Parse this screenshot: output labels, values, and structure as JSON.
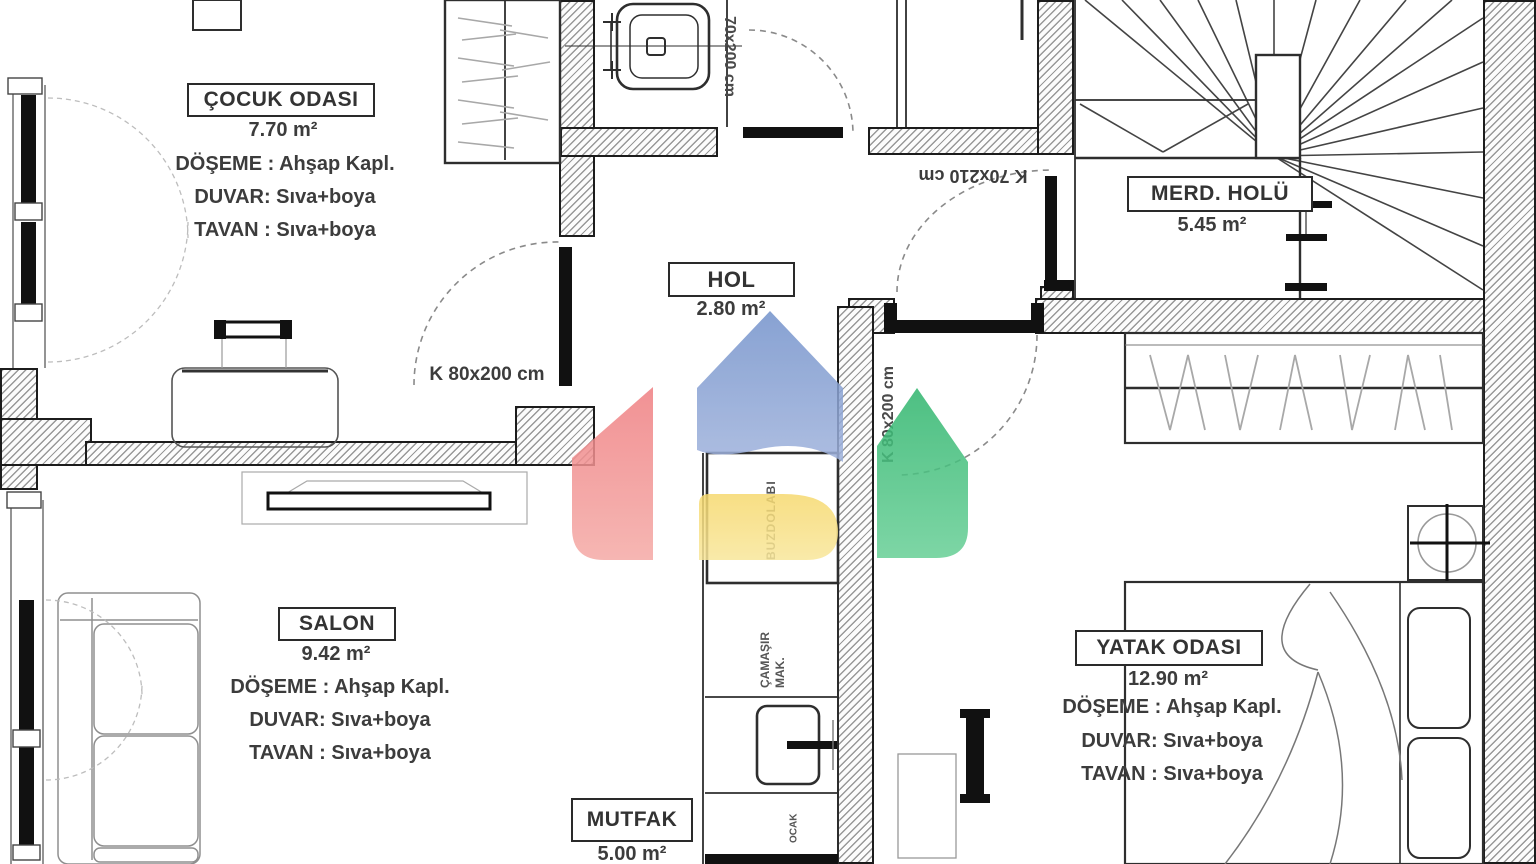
{
  "rooms": {
    "cocuk_odasi": {
      "name": "ÇOCUK ODASI",
      "area": "7.70 m²",
      "floor": "DÖŞEME : Ahşap Kapl.",
      "wall": "DUVAR: Sıva+boya",
      "ceiling": "TAVAN : Sıva+boya"
    },
    "hol": {
      "name": "HOL",
      "area": "2.80 m²"
    },
    "merd_holu": {
      "name": "MERD. HOLÜ",
      "area": "5.45 m²"
    },
    "salon": {
      "name": "SALON",
      "area": "9.42 m²",
      "floor": "DÖŞEME : Ahşap Kapl.",
      "wall": "DUVAR: Sıva+boya",
      "ceiling": "TAVAN : Sıva+boya"
    },
    "mutfak": {
      "name": "MUTFAK",
      "area": "5.00 m²"
    },
    "yatak_odasi": {
      "name": "YATAK ODASI",
      "area": "12.90 m²",
      "floor": "DÖŞEME : Ahşap Kapl.",
      "wall": "DUVAR: Sıva+boya",
      "ceiling": "TAVAN : Sıva+boya"
    }
  },
  "doors": {
    "banyo_kapi": "70x200 cm",
    "vestibul_kapi": "K 70x210 cm",
    "cocuk_kapi": "K 80x200 cm",
    "yatak_kapi": "K 80x200 cm"
  },
  "appliances": {
    "fridge": "BUZDOLABI",
    "washer": "ÇAMAŞIR MAK.",
    "stove": "OCAK"
  },
  "watermark_colors": {
    "red": "#ef7f82",
    "blue": "#7392cb",
    "yellow": "#f6d96f",
    "green": "#2fb56d"
  }
}
